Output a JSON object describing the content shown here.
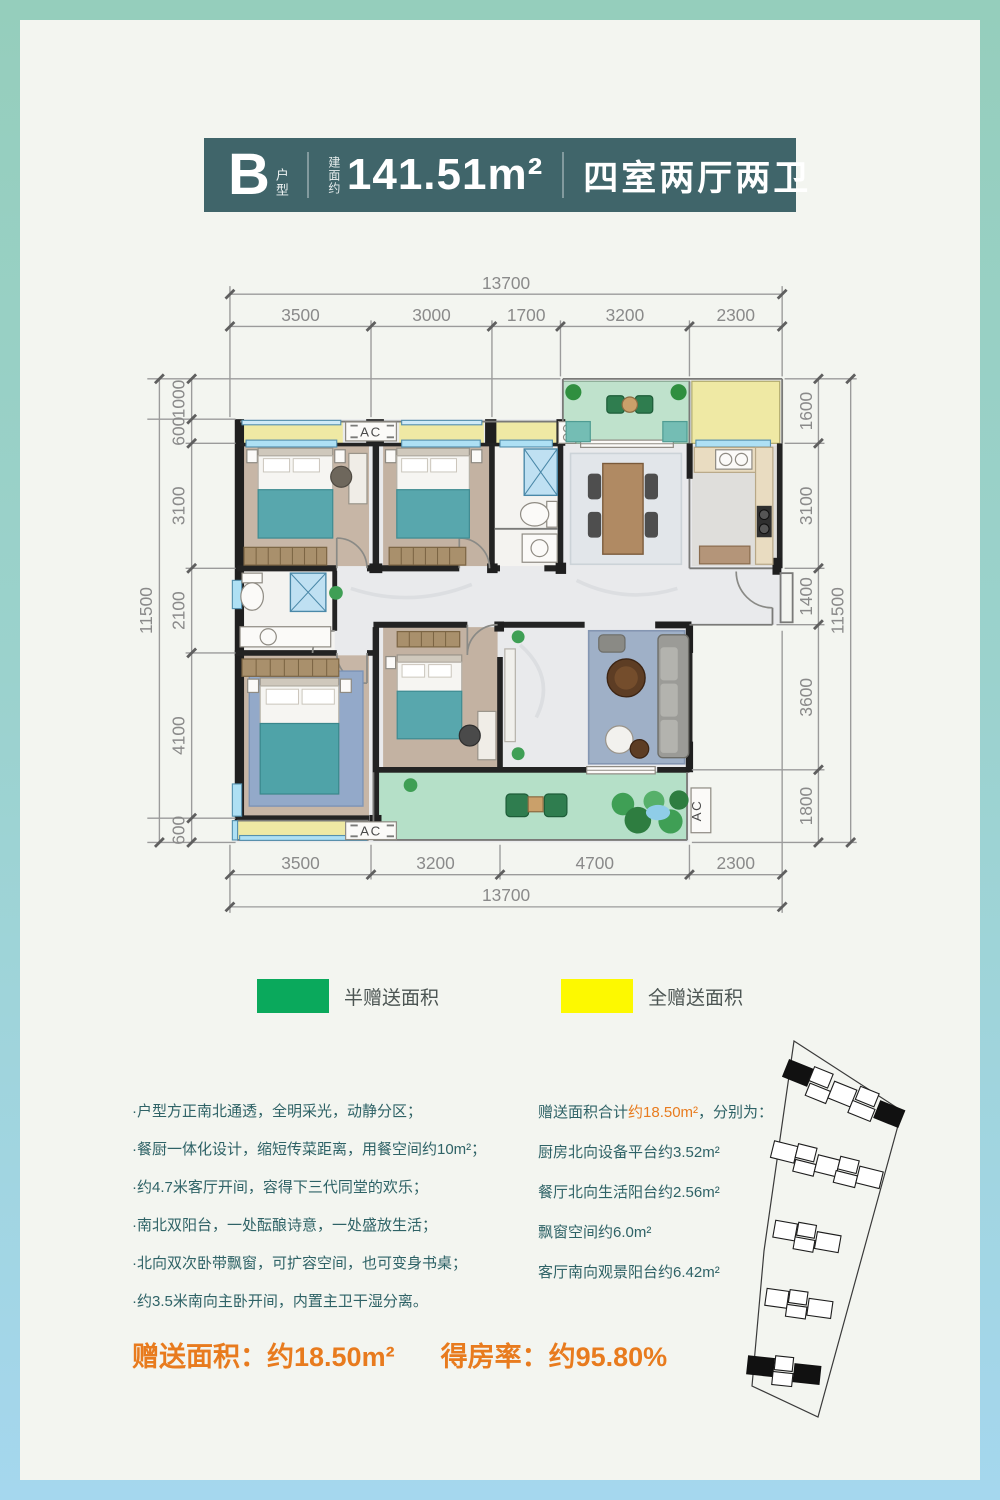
{
  "header": {
    "type_letter": "B",
    "type_suffix": "户型",
    "area_prefix": "建面约",
    "area_value": "141.51m²",
    "rooms": "四室两厅两卫",
    "bg_color": "#40656a"
  },
  "plan": {
    "ac_label": "AC",
    "dims": {
      "top_total": "13700",
      "top": [
        "3500",
        "3000",
        "1700",
        "3200",
        "2300"
      ],
      "bottom": [
        "3500",
        "3200",
        "4700",
        "2300"
      ],
      "bottom_total": "13700",
      "left": [
        "1000",
        "600",
        "3100",
        "2100",
        "4100",
        "600"
      ],
      "left_total": "11500",
      "right": [
        "1600",
        "3100",
        "1400",
        "3600",
        "1800"
      ],
      "right_total": "11500"
    }
  },
  "legend": {
    "half": {
      "label": "半赠送面积",
      "color": "#0aa95c"
    },
    "full": {
      "label": "全赠送面积",
      "color": "#fdf900"
    }
  },
  "features": {
    "items": [
      "·户型方正南北通透，全明采光，动静分区；",
      "·餐厨一体化设计，缩短传菜距离，用餐空间约10m²；",
      "·约4.7米客厅开间，容得下三代同堂的欢乐；",
      "·南北双阳台，一处酝酿诗意，一处盛放生活；",
      "·北向双次卧带飘窗，可扩容空间，也可变身书桌；",
      "·约3.5米南向主卧开间，内置主卫干湿分离。"
    ]
  },
  "gift": {
    "intro_prefix": "赠送面积合计",
    "intro_highlight": "约18.50m²",
    "intro_suffix": "，分别为：",
    "highlight_color": "#e87b1e",
    "items": [
      "厨房北向设备平台约3.52m²",
      "餐厅北向生活阳台约2.56m²",
      "飘窗空间约6.0m²",
      "客厅南向观景阳台约6.42m²"
    ]
  },
  "summary": {
    "part1": "赠送面积：约18.50m²",
    "part2": "得房率：约95.80%",
    "color": "#e87b1e"
  }
}
